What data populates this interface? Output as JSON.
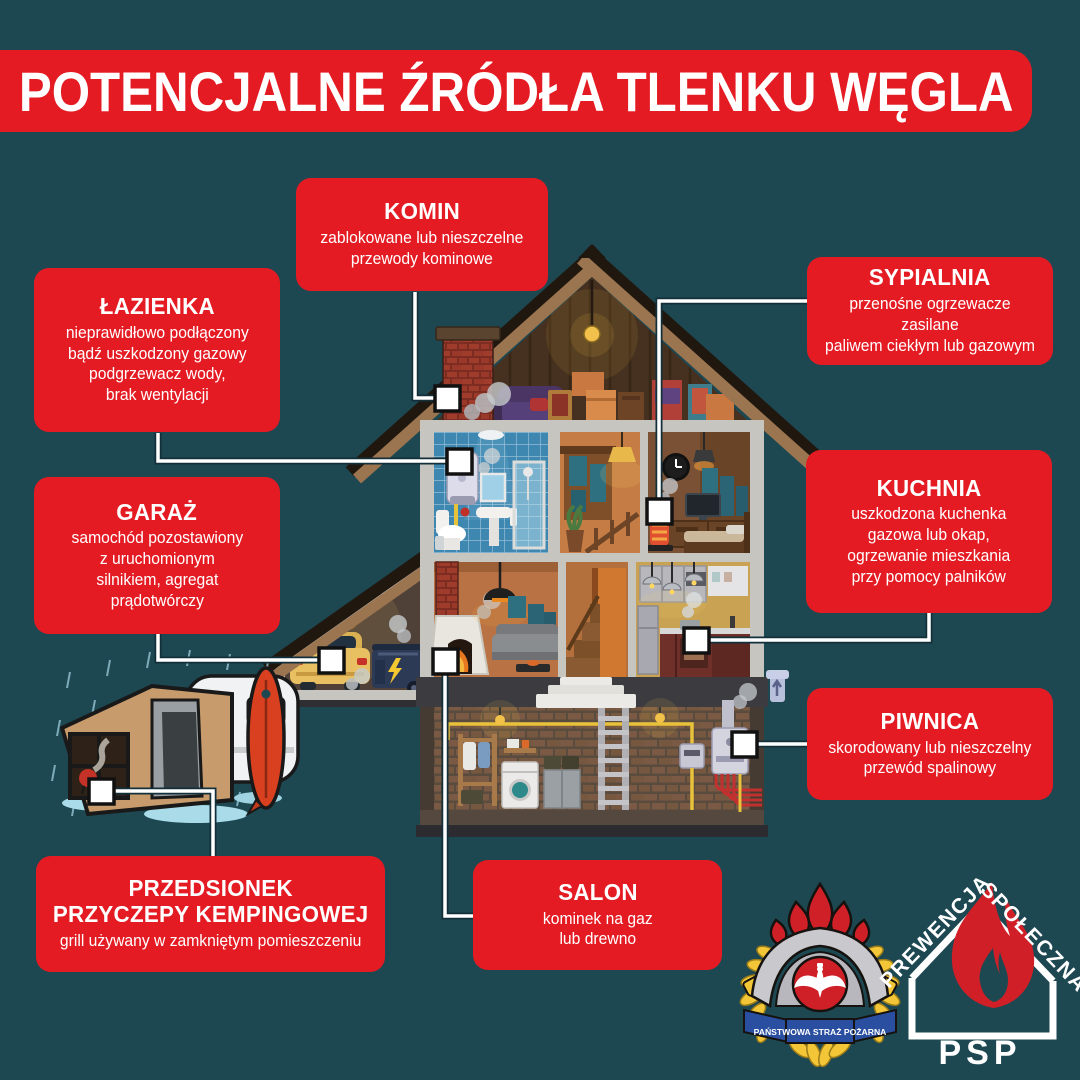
{
  "title": "POTENCJALNE ŹRÓDŁA TLENKU WĘGLA",
  "callouts": {
    "komin": {
      "heading": "KOMIN",
      "body": [
        "zablokowane lub nieszczelne",
        "przewody kominowe"
      ]
    },
    "lazienka": {
      "heading": "ŁAZIENKA",
      "body": [
        "nieprawidłowo podłączony",
        "bądź uszkodzony gazowy",
        "podgrzewacz wody,",
        "brak wentylacji"
      ]
    },
    "sypialnia": {
      "heading": "SYPIALNIA",
      "body": [
        "przenośne ogrzewacze zasilane",
        "paliwem ciekłym lub gazowym"
      ]
    },
    "garaz": {
      "heading": "GARAŻ",
      "body": [
        "samochód pozostawiony",
        "z uruchomionym",
        "silnikiem, agregat",
        "prądotwórczy"
      ]
    },
    "kuchnia": {
      "heading": "KUCHNIA",
      "body": [
        "uszkodzona kuchenka",
        "gazowa lub okap,",
        "ogrzewanie mieszkania",
        "przy pomocy palników"
      ]
    },
    "piwnica": {
      "heading": "PIWNICA",
      "body": [
        "skorodowany lub nieszczelny",
        "przewód spalinowy"
      ]
    },
    "salon": {
      "heading": "SALON",
      "body": [
        "kominek na gaz",
        "lub drewno"
      ]
    },
    "przedsionek": {
      "heading": [
        "PRZEDSIONEK",
        "PRZYCZEPY KEMPINGOWEJ"
      ],
      "body": [
        "grill używany w zamkniętym pomieszczeniu"
      ]
    }
  },
  "logos": {
    "psp_badge": {
      "banner": "PAŃSTWOWA STRAŻ POŻARNA"
    },
    "prewencja": {
      "word_left": "PREWENCJA",
      "word_right": "SPOŁECZNA",
      "abbr": "PSP"
    }
  },
  "colors": {
    "background": "#1d4852",
    "accent_red": "#e41b23",
    "text": "#ffffff",
    "connector_white": "#ffffff",
    "badge_blue": "#2a4fa0",
    "badge_yellow": "#f2c636"
  }
}
